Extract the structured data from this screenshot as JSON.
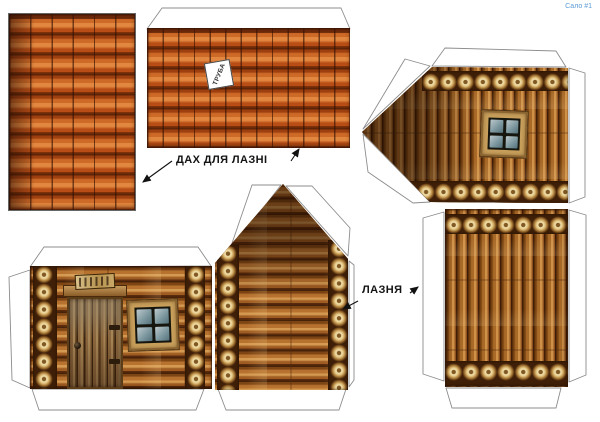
{
  "sheet": {
    "series_label": "Сало #1",
    "labels": {
      "roof_caption": "ДАХ ДЛЯ ЛАЗНІ",
      "building_caption": "ЛАЗНЯ",
      "chimney_tag": "ТРУБА"
    },
    "pieces": {
      "roof_strip": "smalll tiled roof strip",
      "roof_main": "main tiled roof sheet with chimney slot tag",
      "front_wall": "log wall with door, sign and window",
      "front_gable": "log gable wall",
      "gable_end": "log gable end with window",
      "back_wall": "plain log wall"
    },
    "colors": {
      "tile_orange": "#cd6a28",
      "tile_gap": "#5d2407",
      "log_brown": "#9a5a20",
      "log_dark": "#47220a",
      "log_end_tan": "#ecd8a0",
      "glass_blue": "#7e98a0",
      "caption_ink": "#141414",
      "series_blue": "#5b9bd5",
      "tab_outline": "#8c8c8c"
    }
  }
}
